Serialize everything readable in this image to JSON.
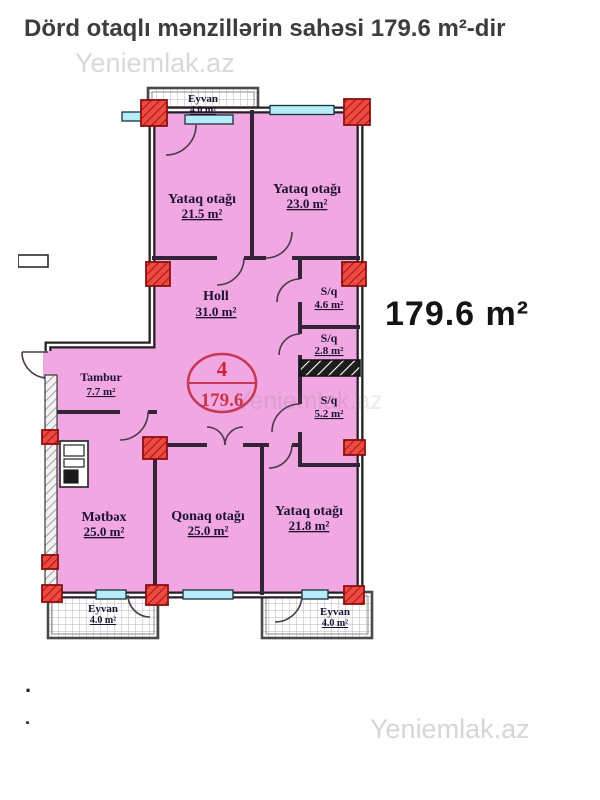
{
  "header": {
    "title": "Dörd otaqlı mənzillərin sahəsi 179.6 m²-dir",
    "watermark": "Yeniemlak.az"
  },
  "plan": {
    "total_area": "179.6 m²",
    "badge": {
      "rooms": "4",
      "area": "179.6"
    },
    "colors": {
      "room_fill": "#f1a7e2",
      "wall": "#2b1d2e",
      "window": "#b5ecf8",
      "column_red": "#ef4a42",
      "badge_red": "#c73853"
    },
    "rooms": [
      {
        "name": "Eyvan",
        "area": "4.0 m²"
      },
      {
        "name": "Yataq otağı",
        "area": "21.5 m²"
      },
      {
        "name": "Yataq otağı",
        "area": "23.0 m²"
      },
      {
        "name": "Holl",
        "area": "31.0 m²"
      },
      {
        "name": "S/q",
        "area": "4.6 m²"
      },
      {
        "name": "S/q",
        "area": "2.8 m²"
      },
      {
        "name": "Tambur",
        "area": "7.7 m²"
      },
      {
        "name": "S/q",
        "area": "5.2 m²"
      },
      {
        "name": "Mətbəx",
        "area": "25.0 m²"
      },
      {
        "name": "Qonaq otağı",
        "area": "25.0 m²"
      },
      {
        "name": "Yataq otağı",
        "area": "21.8 m²"
      },
      {
        "name": "Eyvan",
        "area": "4.0 m²"
      },
      {
        "name": "Eyvan",
        "area": "4.0 m²"
      }
    ]
  },
  "footer": {
    "dots": [
      ".",
      "."
    ],
    "watermark": "Yeniemlak.az"
  }
}
